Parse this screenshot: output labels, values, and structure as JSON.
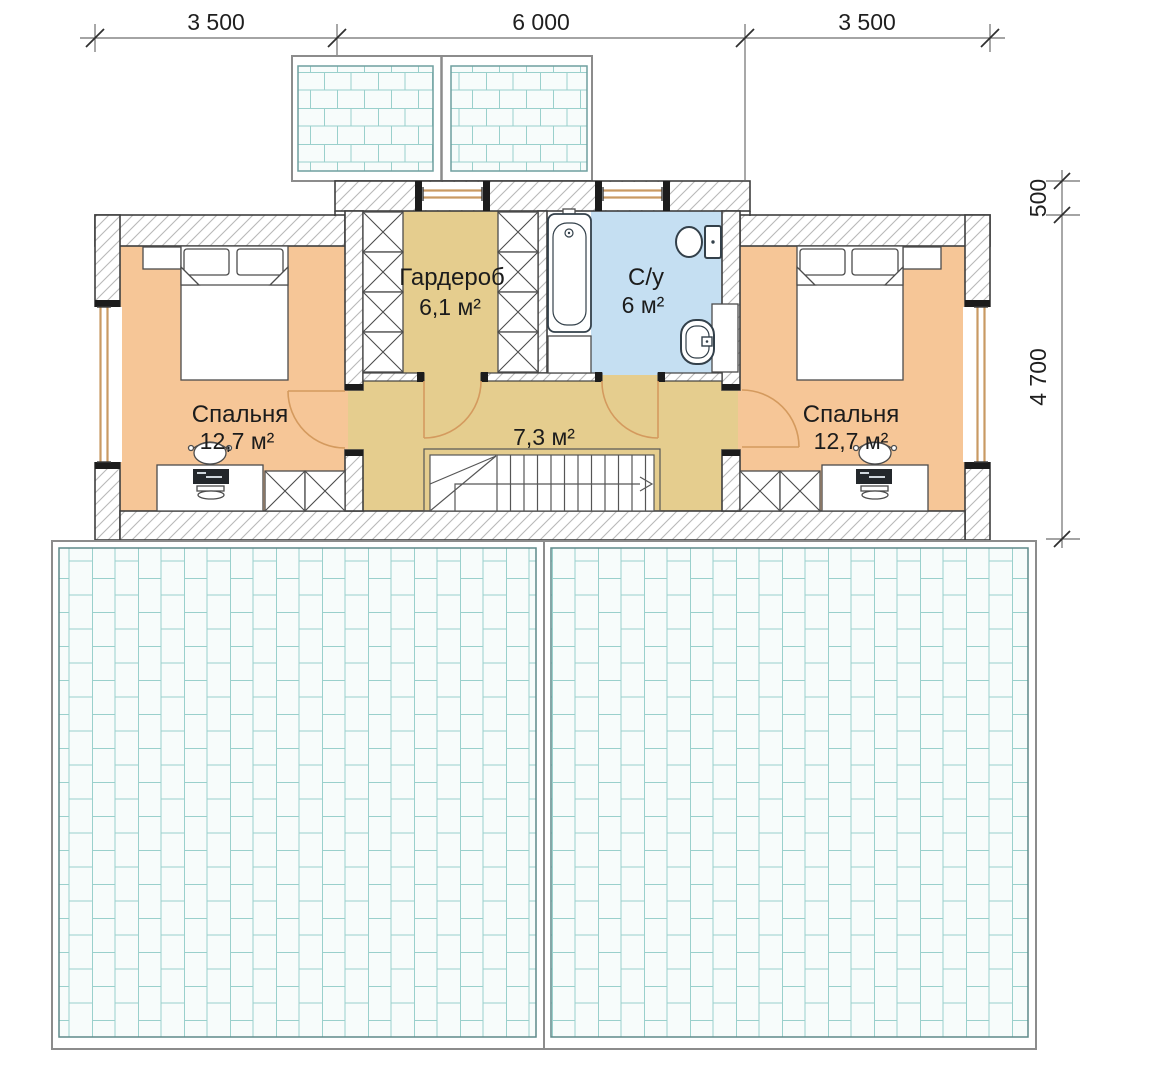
{
  "dimensions": {
    "top": {
      "segments": [
        "3 500",
        "6 000",
        "3 500"
      ]
    },
    "right": {
      "segments": [
        "500",
        "4 700"
      ]
    }
  },
  "rooms": {
    "bedroom_left": {
      "name": "Спальня",
      "area": "12,7 м²"
    },
    "bedroom_right": {
      "name": "Спальня",
      "area": "12,7 м²"
    },
    "wardrobe": {
      "name": "Гардероб",
      "area": "6,1 м²"
    },
    "bathroom": {
      "name": "С/у",
      "area": "6 м²"
    },
    "hall": {
      "area": "7,3 м²"
    }
  },
  "colors": {
    "bedroom_fill": "#f6c697",
    "hall_fill": "#e5cd8e",
    "wardrobe_fill": "#e5cd8e",
    "bathroom_fill": "#c5dff2",
    "roof_line": "#9ad0cc",
    "roof_bg": "#f7fcfb",
    "window_frame": "#c99a63",
    "door_swing": "#d49a5e"
  }
}
